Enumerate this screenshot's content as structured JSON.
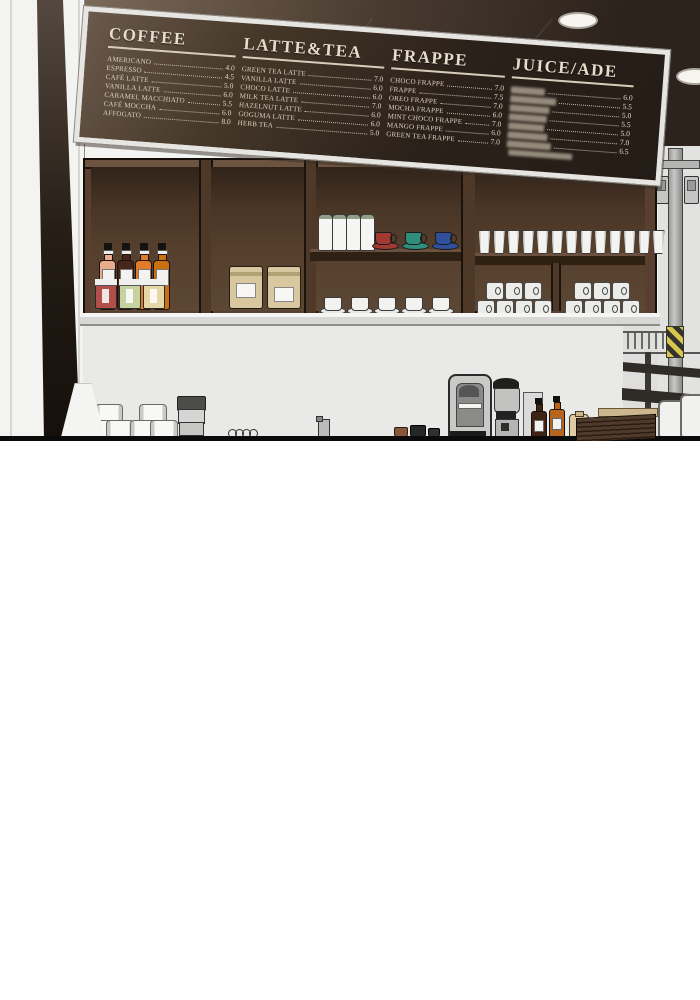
{
  "menu_board": {
    "frame_color": "#e7e5e1",
    "text_color": "#ddd2c0",
    "bg_dark": "#241c16",
    "bg_light": "#6a594c",
    "sections": [
      {
        "title": "COFFEE",
        "items": [
          {
            "name": "AMERICANO",
            "price": "4.0"
          },
          {
            "name": "ESPRESSO",
            "price": "4.5"
          },
          {
            "name": "CAFÉ LATTE",
            "price": "5.0"
          },
          {
            "name": "VANILLA LATTE",
            "price": "6.0"
          },
          {
            "name": "CARAMEL MACCHIATO",
            "price": "5.5"
          },
          {
            "name": "CAFÉ MOCCHA",
            "price": "6.0"
          },
          {
            "name": "AFFOGATO",
            "price": "8.0"
          }
        ]
      },
      {
        "title": "LATTE&TEA",
        "items": [
          {
            "name": "GREEN TEA LATTE",
            "price": "7.0"
          },
          {
            "name": "VANILLA LATTE",
            "price": "6.0"
          },
          {
            "name": "CHOCO LATTE",
            "price": "6.0"
          },
          {
            "name": "MILK TEA LATTE",
            "price": "7.0"
          },
          {
            "name": "HAZELNUT LATTE",
            "price": "6.0"
          },
          {
            "name": "GOGUMA LATTE",
            "price": "6.0"
          },
          {
            "name": "HERB TEA",
            "price": "5.0"
          }
        ]
      },
      {
        "title": "FRAPPE",
        "items": [
          {
            "name": "CHOCO FRAPPE",
            "price": "7.0"
          },
          {
            "name": "FRAPPE",
            "price": "7.5"
          },
          {
            "name": "OREO FRAPPE",
            "price": "7.0"
          },
          {
            "name": "MOCHA FRAPPE",
            "price": "6.0"
          },
          {
            "name": "MINT CHOCO FRAPPE",
            "price": "7.0"
          },
          {
            "name": "MANGO FRAPPE",
            "price": "6.0"
          },
          {
            "name": "GREEN TEA FRAPPE",
            "price": "7.0"
          }
        ]
      },
      {
        "title": "JUICE/ADE",
        "footer_blur": true,
        "items": [
          {
            "blurred": true,
            "blur_width": 34,
            "price": "6.0"
          },
          {
            "blurred": true,
            "blur_width": 46,
            "price": "5.5"
          },
          {
            "blurred": true,
            "blur_width": 40,
            "price": "5.0"
          },
          {
            "blurred": true,
            "blur_width": 38,
            "price": "5.5"
          },
          {
            "blurred": true,
            "blur_width": 36,
            "price": "5.0"
          },
          {
            "blurred": true,
            "blur_width": 40,
            "price": "7.0"
          },
          {
            "blurred": true,
            "blur_width": 44,
            "price": "6.5"
          }
        ]
      }
    ]
  },
  "scene": {
    "ceiling": {
      "light_count": 2,
      "color_light": "#7b6a5a",
      "color_dark": "#2c231c"
    },
    "cabinet": {
      "wood": "#583f2f",
      "wood_dark": "#3c2a1e",
      "syrup_bottles": [
        "#e8ab8c",
        "#46261a",
        "#df7d2a",
        "#c9710f"
      ],
      "jars": [
        "#b15048",
        "#c6d2a2",
        "#e6d8a6"
      ],
      "coffee_bag_count": 2,
      "bag_color": "#d9c89f",
      "milk_bottle_count": 4,
      "tea_cup_colors": [
        "#a03a32",
        "#2f8e7c",
        "#30509e"
      ],
      "white_cup_count": 5,
      "paper_cup_count": 13,
      "mug_group_count": 2,
      "mug_rows": [
        3,
        4
      ]
    },
    "counter": {
      "glass_stack_count": 2,
      "pitcher_segments": 3,
      "tray_count": 7,
      "syrup_bottles": [
        "#3f2315",
        "#b9641c"
      ]
    },
    "street": {
      "hazard_yellow": "#d6c64e",
      "pole_gray": "#b5b5b3",
      "chair_count": 2
    }
  }
}
